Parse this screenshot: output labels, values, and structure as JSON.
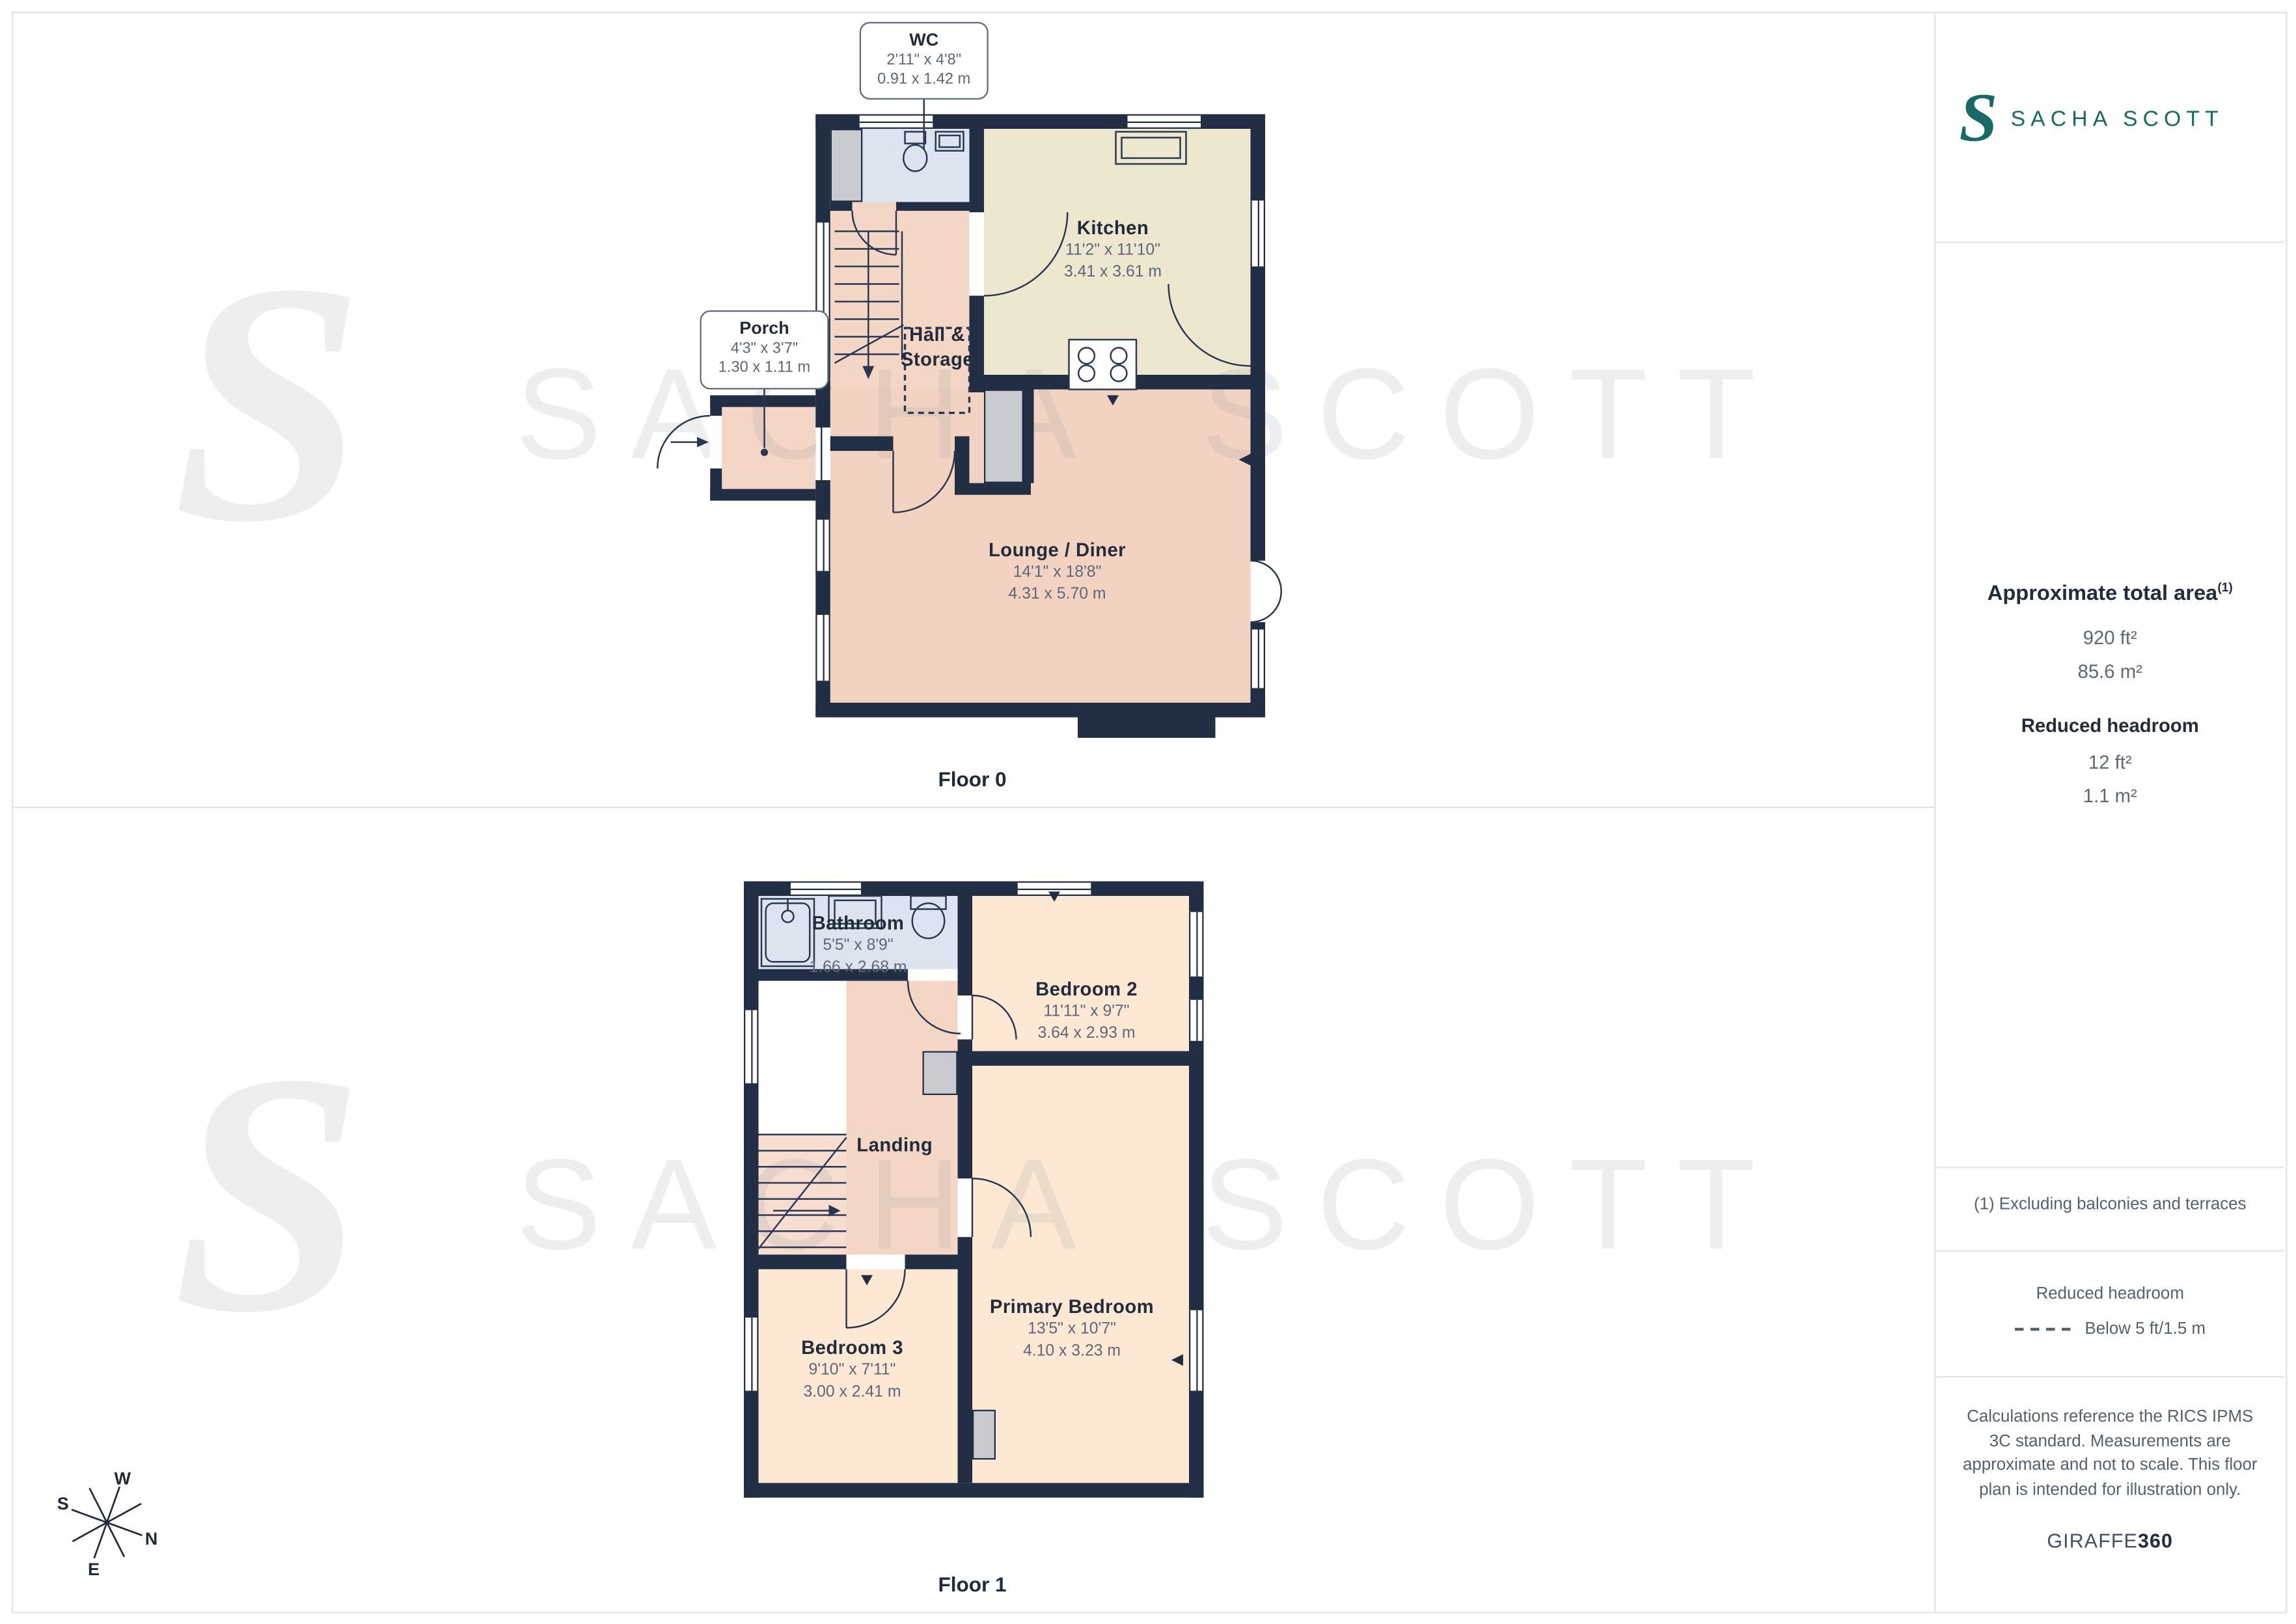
{
  "brand": {
    "monogram": "S",
    "name": "SACHA SCOTT",
    "teal": "#176a66"
  },
  "watermark": {
    "monogram": "S",
    "text": "SACHA SCOTT"
  },
  "compass": {
    "n": "N",
    "e": "E",
    "s": "S",
    "w": "W"
  },
  "floors": [
    {
      "label": "Floor 0",
      "rooms": [
        {
          "name": "WC",
          "imperial": "2'11\" x 4'8\"",
          "metric": "0.91 x 1.42 m"
        },
        {
          "name": "Porch",
          "imperial": "4'3\" x 3'7\"",
          "metric": "1.30 x 1.11 m"
        },
        {
          "name": "Kitchen",
          "imperial": "11'2\" x 11'10\"",
          "metric": "3.41 x 3.61 m"
        },
        {
          "name": "Hall & Storage"
        },
        {
          "name": "Lounge / Diner",
          "imperial": "14'1\" x 18'8\"",
          "metric": "4.31 x 5.70 m"
        }
      ]
    },
    {
      "label": "Floor 1",
      "rooms": [
        {
          "name": "Bathroom",
          "imperial": "5'5\" x 8'9\"",
          "metric": "1.66 x 2.68 m"
        },
        {
          "name": "Bedroom 2",
          "imperial": "11'11\" x 9'7\"",
          "metric": "3.64 x 2.93 m"
        },
        {
          "name": "Landing"
        },
        {
          "name": "Bedroom 3",
          "imperial": "9'10\" x 7'11\"",
          "metric": "3.00 x 2.41 m"
        },
        {
          "name": "Primary Bedroom",
          "imperial": "13'5\" x 10'7\"",
          "metric": "4.10 x 3.23 m"
        }
      ]
    }
  ],
  "sidebar": {
    "area_title": "Approximate total area",
    "area_footnote_marker": "(1)",
    "area_ft": "920 ft²",
    "area_m": "85.6 m²",
    "reduced_headroom_title": "Reduced headroom",
    "reduced_ft": "12 ft²",
    "reduced_m": "1.1 m²",
    "footnote": "(1) Excluding balconies and terraces",
    "legend_title": "Reduced headroom",
    "legend_label": "Below 5 ft/1.5 m",
    "disclaimer": "Calculations reference the RICS IPMS 3C standard. Measurements are approximate and not to scale. This floor plan is intended for illustration only.",
    "credit_normal": "GIRAFFE",
    "credit_bold": "360"
  }
}
